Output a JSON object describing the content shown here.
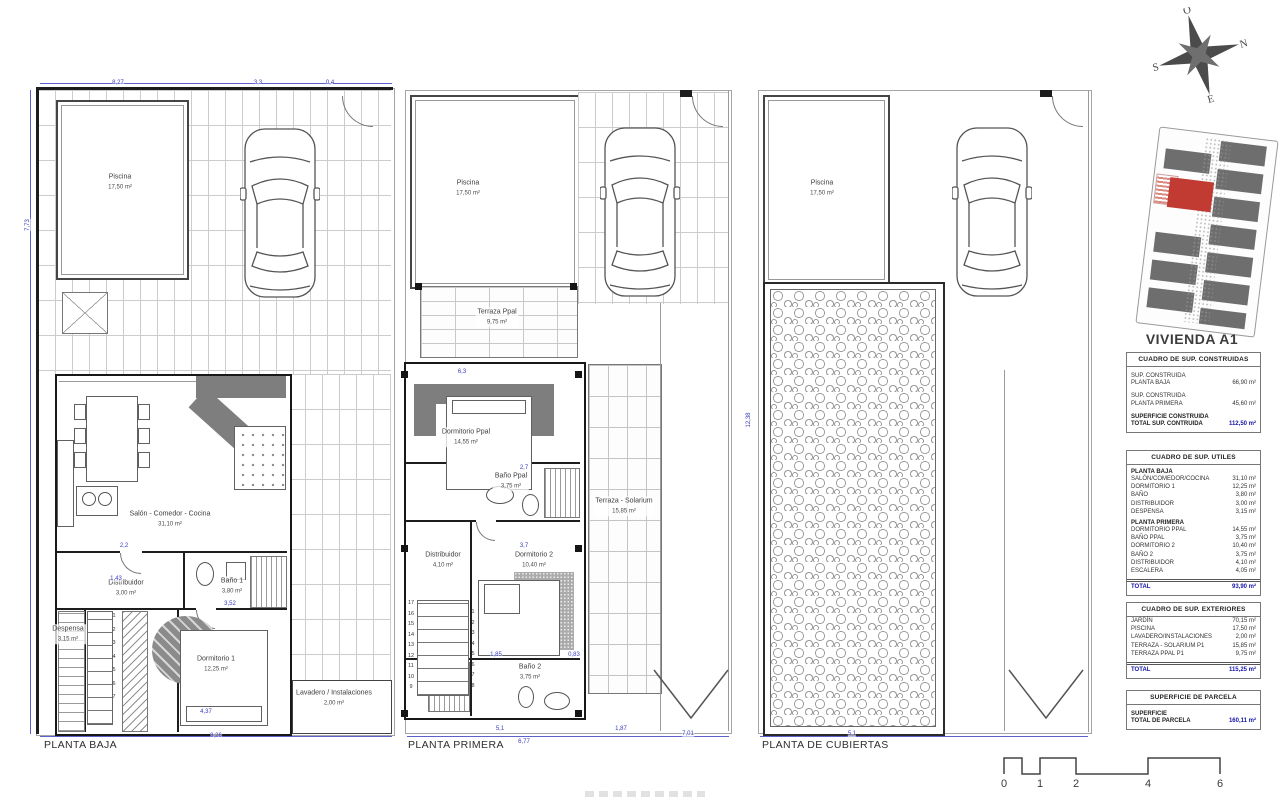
{
  "title": "VIVIENDA A1",
  "plans": [
    {
      "label": "PLANTA BAJA",
      "rooms": [
        {
          "name": "Piscina",
          "area": "17,50 m²",
          "x": 120,
          "y": 182
        },
        {
          "name": "Salón - Comedor - Cocina",
          "area": "31,10 m²",
          "x": 170,
          "y": 519
        },
        {
          "name": "Distribuidor",
          "area": "3,00 m²",
          "x": 126,
          "y": 588
        },
        {
          "name": "Baño 1",
          "area": "3,80 m²",
          "x": 232,
          "y": 586
        },
        {
          "name": "Despensa",
          "area": "3,15 m²",
          "x": 68,
          "y": 634
        },
        {
          "name": "Dormitorio 1",
          "area": "12,25 m²",
          "x": 216,
          "y": 664
        },
        {
          "name": "Lavadero / Instalaciones",
          "area": "2,00 m²",
          "x": 334,
          "y": 698
        }
      ]
    },
    {
      "label": "PLANTA PRIMERA",
      "rooms": [
        {
          "name": "Piscina",
          "area": "17,50 m²",
          "x": 468,
          "y": 188
        },
        {
          "name": "Terraza Ppal",
          "area": "9,75 m²",
          "x": 497,
          "y": 317
        },
        {
          "name": "Dormitorio Ppal",
          "area": "14,55 m²",
          "x": 466,
          "y": 437
        },
        {
          "name": "Baño Ppal",
          "area": "3,75 m²",
          "x": 511,
          "y": 481
        },
        {
          "name": "Distribuidor",
          "area": "4,10 m²",
          "x": 443,
          "y": 560
        },
        {
          "name": "Dormitorio 2",
          "area": "10,40 m²",
          "x": 534,
          "y": 560
        },
        {
          "name": "Baño 2",
          "area": "3,75 m²",
          "x": 530,
          "y": 672
        },
        {
          "name": "Terraza - Solarium",
          "area": "15,85 m²",
          "x": 624,
          "y": 506
        }
      ]
    },
    {
      "label": "PLANTA DE CUBIERTAS",
      "rooms": [
        {
          "name": "Piscina",
          "area": "17,50 m²",
          "x": 822,
          "y": 188
        }
      ]
    }
  ],
  "compass": {
    "n": "N",
    "s": "S",
    "e": "E",
    "o": "O"
  },
  "tables": {
    "construidas": {
      "header": "CUADRO DE SUP. CONSTRUIDAS",
      "rows": [
        {
          "l1": "SUP. CONSTRUIDA",
          "l2": "PLANTA BAJA",
          "v": "66,90 m²"
        },
        {
          "l1": "SUP. CONSTRUIDA",
          "l2": "PLANTA PRIMERA",
          "v": "45,60 m²"
        }
      ],
      "total": {
        "l1": "SUPERFICIE CONSTRUIDA",
        "l2": "TOTAL SUP. CONTRUIDA",
        "v": "112,50 m²"
      }
    },
    "utiles": {
      "header": "CUADRO DE SUP. UTILES",
      "sections": [
        {
          "title": "PLANTA BAJA",
          "items": [
            [
              "SALÓN/COMEDOR/COCINA",
              "31,10 m²"
            ],
            [
              "DORMITORIO 1",
              "12,25 m²"
            ],
            [
              "BAÑO",
              "3,80 m²"
            ],
            [
              "DISTRIBUIDOR",
              "3,00 m²"
            ],
            [
              "DESPENSA",
              "3,15 m²"
            ]
          ]
        },
        {
          "title": "PLANTA PRIMERA",
          "items": [
            [
              "DORMITORIO PPAL",
              "14,55 m²"
            ],
            [
              "BAÑO PPAL",
              "3,75 m²"
            ],
            [
              "DORMITORIO 2",
              "10,40 m²"
            ],
            [
              "BAÑO 2",
              "3,75 m²"
            ],
            [
              "DISTRIBUIDOR",
              "4,10 m²"
            ],
            [
              "ESCALERA",
              "4,05 m²"
            ]
          ]
        }
      ],
      "total": {
        "l1": "TOTAL",
        "v": "93,90 m²"
      }
    },
    "exteriores": {
      "header": "CUADRO DE SUP. EXTERIORES",
      "items": [
        [
          "JARDÍN",
          "70,15 m²"
        ],
        [
          "PISCINA",
          "17,50 m²"
        ],
        [
          "LAVADERO/INSTALACIONES",
          "2,00 m²"
        ],
        [
          "TERRAZA - SOLARIUM P1",
          "15,85 m²"
        ],
        [
          "TERRAZA PPAL P1",
          "9,75 m²"
        ]
      ],
      "total": {
        "l1": "TOTAL",
        "v": "115,25 m²"
      }
    },
    "parcela": {
      "header": "SUPERFICIE DE PARCELA",
      "total": {
        "l1": "SUPERFICIE",
        "l2": "TOTAL DE PARCELA",
        "v": "160,11 m²"
      }
    }
  },
  "accent_colors": {
    "dimension_blue": "#3a3ac2",
    "total_blue": "#1515a8",
    "highlight_red": "#c13b32"
  },
  "dims": [
    {
      "t": "8,27",
      "x": 118,
      "y": 83
    },
    {
      "t": "3,3",
      "x": 258,
      "y": 83
    },
    {
      "t": "0,4",
      "x": 330,
      "y": 83
    },
    {
      "t": "7,73",
      "x": 28,
      "y": 225,
      "v": 1
    },
    {
      "t": "8,26",
      "x": 216,
      "y": 736
    },
    {
      "t": "2,2",
      "x": 124,
      "y": 546
    },
    {
      "t": "1,43",
      "x": 116,
      "y": 579
    },
    {
      "t": "3,52",
      "x": 230,
      "y": 604
    },
    {
      "t": "4,37",
      "x": 206,
      "y": 712
    },
    {
      "t": "6,3",
      "x": 462,
      "y": 372
    },
    {
      "t": "2,7",
      "x": 524,
      "y": 468
    },
    {
      "t": "3,7",
      "x": 524,
      "y": 546
    },
    {
      "t": "1,85",
      "x": 496,
      "y": 655
    },
    {
      "t": "0,83",
      "x": 574,
      "y": 655
    },
    {
      "t": "5,1",
      "x": 500,
      "y": 729
    },
    {
      "t": "6,77",
      "x": 524,
      "y": 742
    },
    {
      "t": "1,87",
      "x": 621,
      "y": 729
    },
    {
      "t": "7,01",
      "x": 688,
      "y": 734
    },
    {
      "t": "5,1",
      "x": 852,
      "y": 734
    },
    {
      "t": "12,38",
      "x": 749,
      "y": 420,
      "v": 1
    }
  ],
  "stairs": [
    {
      "x": 114,
      "y": 616,
      "dy": 13.5,
      "nums": [
        "1",
        "2",
        "3",
        "4",
        "5",
        "6",
        "7"
      ]
    },
    {
      "x": 473,
      "y": 612,
      "dy": 10.5,
      "nums": [
        "1",
        "2",
        "3",
        "4",
        "5",
        "6",
        "7",
        "8"
      ]
    },
    {
      "x": 411,
      "y": 603,
      "dy": 10.5,
      "nums": [
        "17",
        "16",
        "15",
        "14",
        "13",
        "12",
        "11",
        "10",
        "9"
      ]
    }
  ],
  "scalebar": {
    "labels": [
      "0",
      "1",
      "2",
      "4",
      "6"
    ]
  }
}
